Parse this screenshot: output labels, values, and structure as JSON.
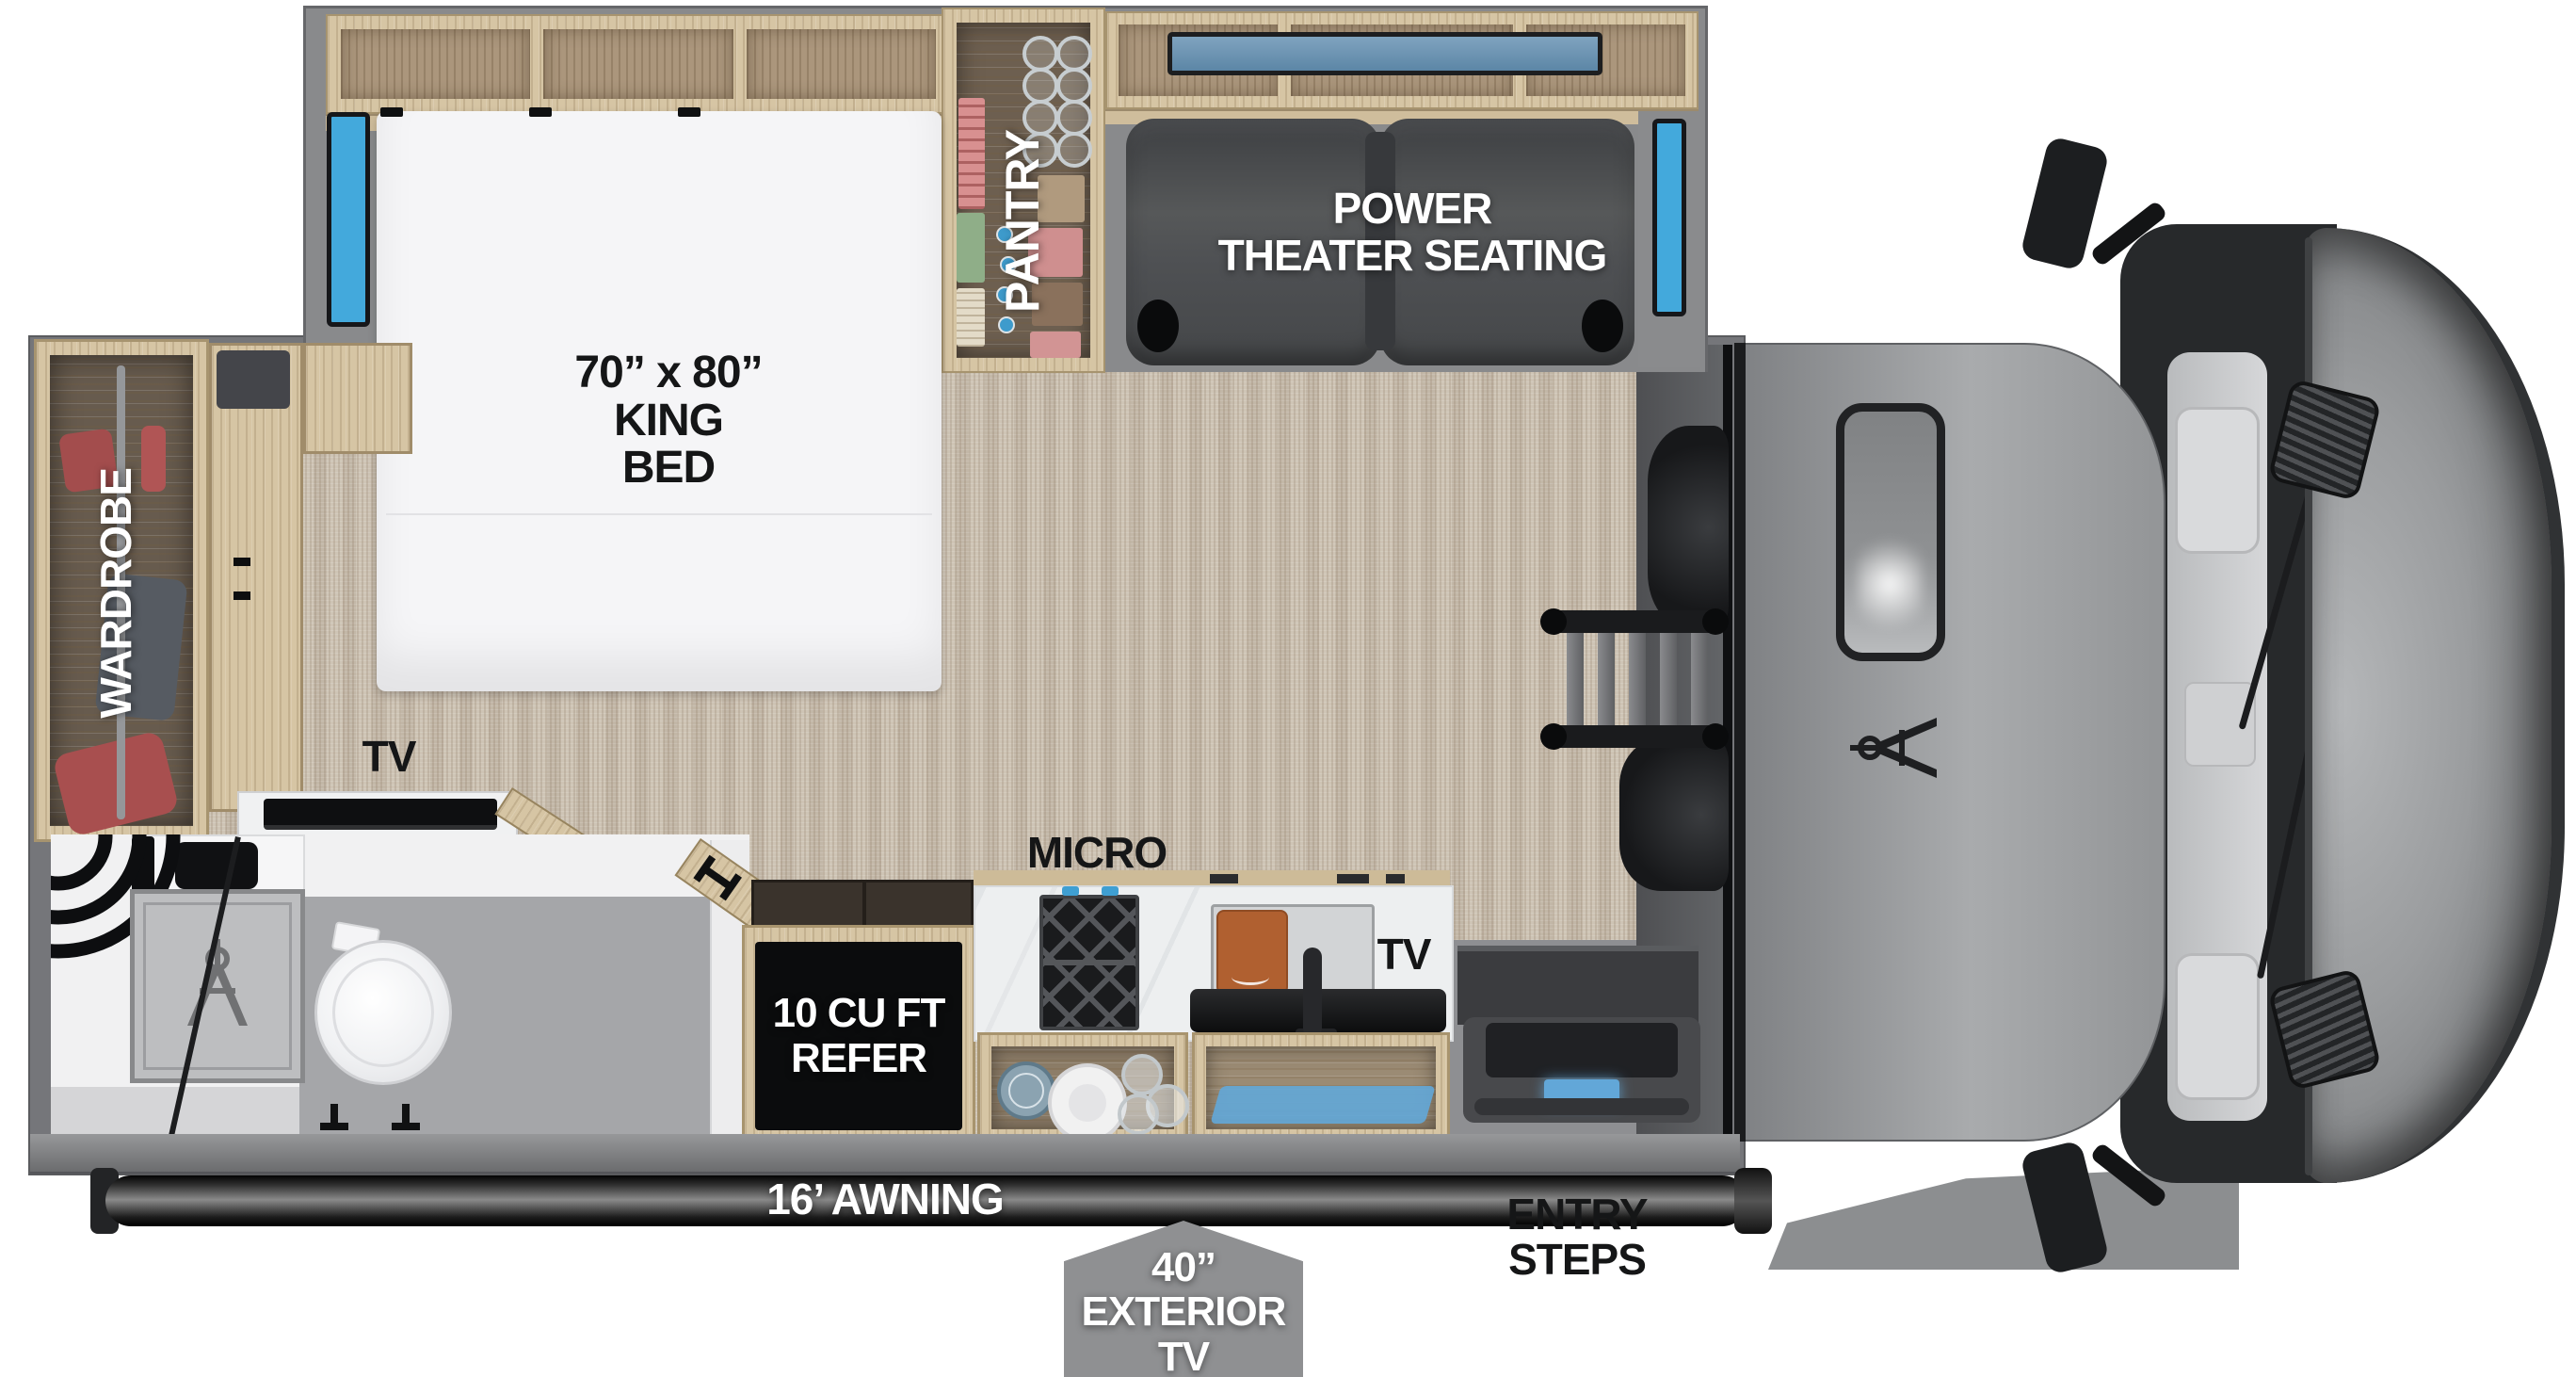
{
  "labels": {
    "bed_size": "70” x 80”",
    "bed_line2": "KING",
    "bed_line3": "BED",
    "pantry": "PANTRY",
    "theater_line1": "POWER",
    "theater_line2": "THEATER SEATING",
    "wardrobe": "WARDROBE",
    "bedroom_tv": "TV",
    "micro": "MICRO",
    "kitchen_tv": "TV",
    "refer_line1": "10 CU FT",
    "refer_line2": "REFER",
    "awning": "16’ AWNING",
    "entry_steps": "ENTRY STEPS",
    "exterior_tv_line1": "40” EXTERIOR",
    "exterior_tv_line2": "TV"
  },
  "colors": {
    "window_blue": "#43a9dc",
    "step_light_blue": "#62a7d8",
    "carpet_beige": "#cec4b5",
    "wood_light": "#d6c5a4",
    "wood_panel": "#ab967c",
    "seat_gray": "#4e5053",
    "cab_gray": "#9fa1a3",
    "refer_black": "#0b0c0d",
    "tab_gray": "#8f9092",
    "label_white": "#ffffff",
    "label_black": "#151617"
  },
  "icons": {
    "brand_logo": "drafting-compass"
  }
}
